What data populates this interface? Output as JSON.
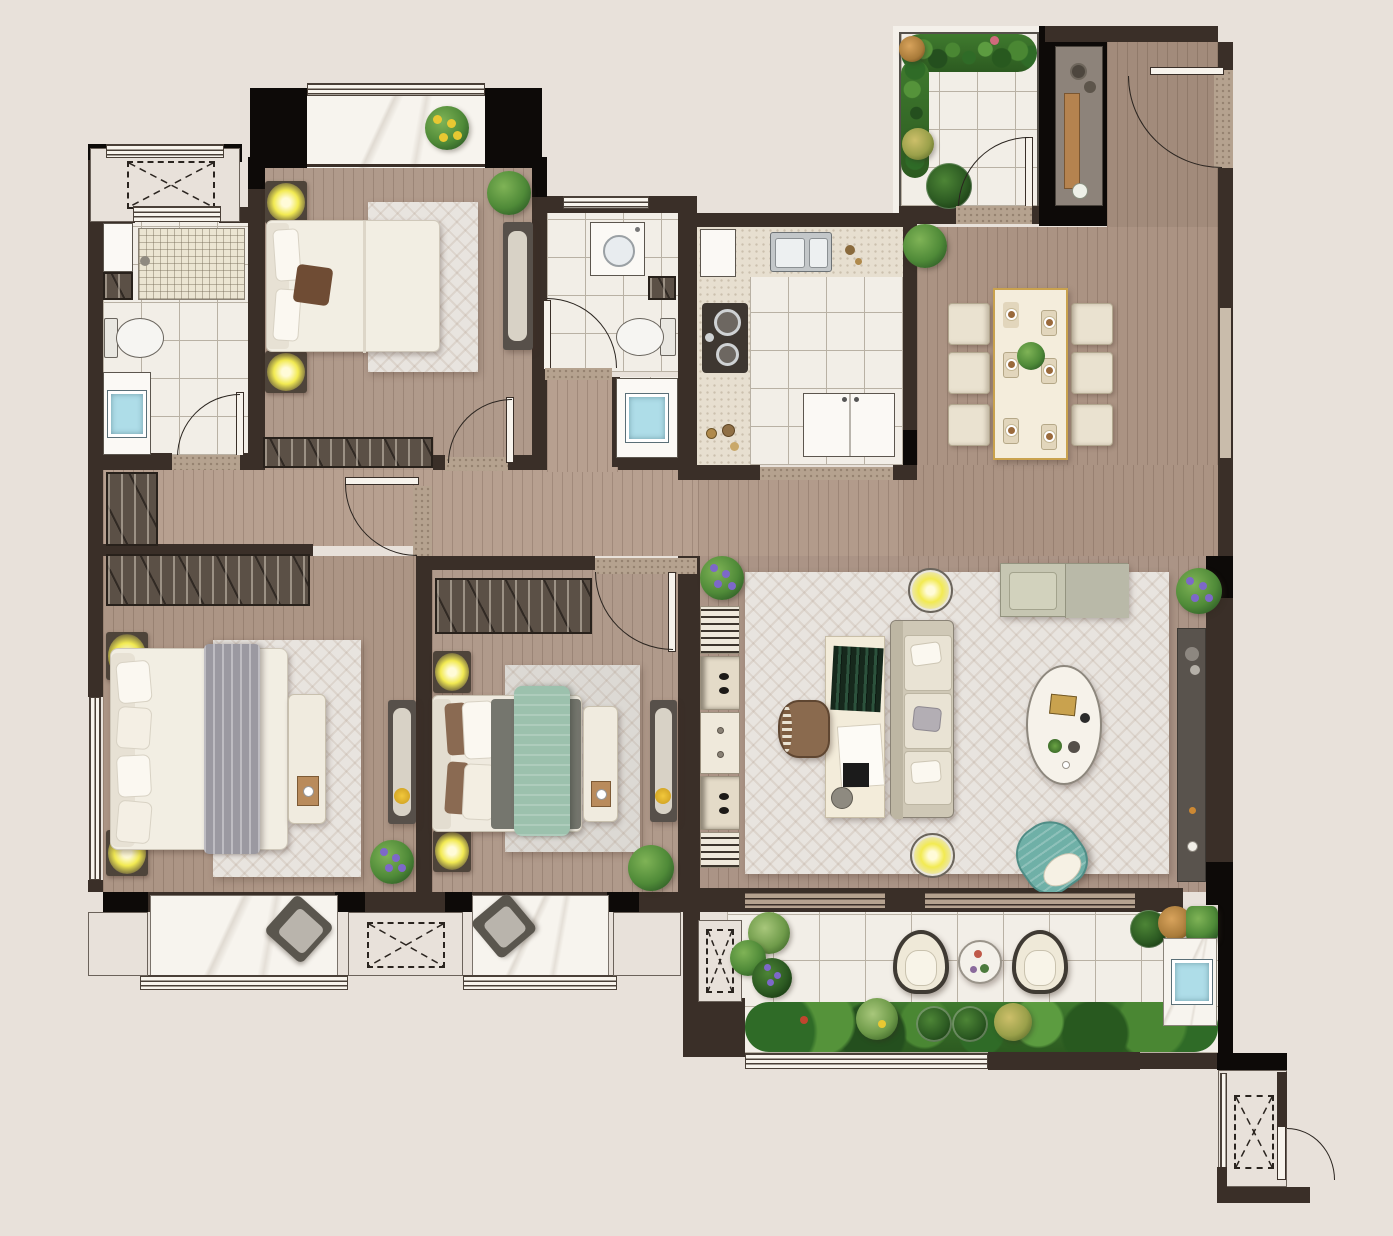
{
  "meta": {
    "title": "apartment-floor-plan-rendering",
    "view": "top-down color architectural render",
    "visible_text": []
  },
  "palette": {
    "background": "#e8e1da",
    "wall": "#3a2f28",
    "wall_black": "#0d0a08",
    "wood": "#ad9586",
    "wood_bedroom": "#b09a8b",
    "wood_entry": "#a28b7b",
    "tile": "#f2eee7",
    "tile_line": "#b9b1a4",
    "marble": "#f7f4ee",
    "counter": "#e7dfd0",
    "threshold": "#b5a28f",
    "rug": "#e8e4df",
    "wardrobe": "#5b5046",
    "lamp_glow": "#f2ea52",
    "teal": "#6fb0a7",
    "bed_green": "#9cc1ad",
    "bed_gray": "#9b99a1",
    "plant_dark": "#2e5c26",
    "plant_mid": "#4f8a38",
    "plant_light": "#7fb356",
    "flower_purple": "#7d68c9",
    "flower_yellow": "#e8c832",
    "water_blue": "#aedde8",
    "table_gold": "#c9a24e",
    "console_pad": "#8d837a",
    "tv_console": "#59534d",
    "sofa": "#e6dfcf",
    "desk": "#f3ecda",
    "books_green": "#20402e",
    "chair_brown": "#8a6a4e"
  },
  "rooms": [
    {
      "id": "ac-platform-north",
      "name": "AC platform (north)",
      "furniture": [
        "equipment pad with dashed X marker",
        "window"
      ]
    },
    {
      "id": "bathroom-1",
      "name": "Bathroom 1",
      "furniture": [
        "walk-in shower mat",
        "toilet",
        "vanity with blue basin",
        "storage niche",
        "swing door"
      ]
    },
    {
      "id": "balcony-north",
      "name": "North balcony",
      "furniture": [
        "marble floor",
        "yellow flower pot",
        "window band"
      ]
    },
    {
      "id": "bedroom-north",
      "name": "North bedroom",
      "furniture": [
        "double bed",
        "2 nightstand lamps",
        "area rug",
        "wall bench",
        "built-in wardrobe",
        "potted plant",
        "swing door"
      ]
    },
    {
      "id": "bathroom-2",
      "name": "Bathroom 2",
      "furniture": [
        "washing machine",
        "toilet",
        "storage niche",
        "swing door",
        "vanity with blue basin outside"
      ]
    },
    {
      "id": "kitchen",
      "name": "Kitchen",
      "furniture": [
        "double-bowl sink",
        "two-burner cooktop",
        "L-shaped counter",
        "refrigerator",
        "window shelf"
      ]
    },
    {
      "id": "entry-courtyard",
      "name": "Entry courtyard",
      "furniture": [
        "paved tile floor",
        "planting border",
        "clover plant",
        "courtyard door"
      ]
    },
    {
      "id": "foyer",
      "name": "Entry foyer",
      "furniture": [
        "console table",
        "wood tray",
        "vase",
        "main entry door"
      ]
    },
    {
      "id": "dining-area",
      "name": "Dining area",
      "furniture": [
        "six-seat dining table with gold-rim marble top",
        "6 upholstered chairs",
        "centerpiece plant",
        "corner plant"
      ]
    },
    {
      "id": "living-room",
      "name": "Living room",
      "furniture": [
        "large area rug",
        "three-seat sofa",
        "writing desk with green books",
        "office chair",
        "2 floor lamps",
        "oval coffee table",
        "double chaise daybed",
        "teal accent armchair",
        "TV console",
        "five-cell storage shelf",
        "potted plants"
      ]
    },
    {
      "id": "master-bedroom",
      "name": "Master bedroom",
      "furniture": [
        "king bed with gray throw",
        "2 nightstand lamps",
        "area rug",
        "white bench with tray",
        "built-in wardrobe",
        "wall daybench",
        "potted plant",
        "side window"
      ]
    },
    {
      "id": "bedroom-2",
      "name": "Bedroom 2",
      "furniture": [
        "double bed with green quilt",
        "2 nightstand lamps",
        "area rug",
        "white bench with tray",
        "built-in wardrobe",
        "wall daybench",
        "potted plant",
        "swing door"
      ]
    },
    {
      "id": "bay-window-master",
      "name": "Bay window (master)",
      "furniture": [
        "marble seat",
        "decor cushion"
      ]
    },
    {
      "id": "bay-window-2",
      "name": "Bay window (bedroom 2)",
      "furniture": [
        "marble seat",
        "decor cushion"
      ]
    },
    {
      "id": "ac-platform-south",
      "name": "AC platform (south)",
      "furniture": [
        "equipment pad with dashed X marker"
      ]
    },
    {
      "id": "balcony-south",
      "name": "South balcony garden terrace",
      "furniture": [
        "2 rattan lounge chairs",
        "round side table",
        "planting border with topiary",
        "outdoor wash basin",
        "side AC pad"
      ]
    },
    {
      "id": "utility-platform",
      "name": "Utility platform",
      "furniture": [
        "equipment pad with dashed X marker",
        "access door"
      ]
    },
    {
      "id": "hallway",
      "name": "Hallway",
      "furniture": [
        "shoe cabinet",
        "door to master bedroom",
        "door to bedroom 2",
        "door to bathroom 1"
      ]
    }
  ]
}
